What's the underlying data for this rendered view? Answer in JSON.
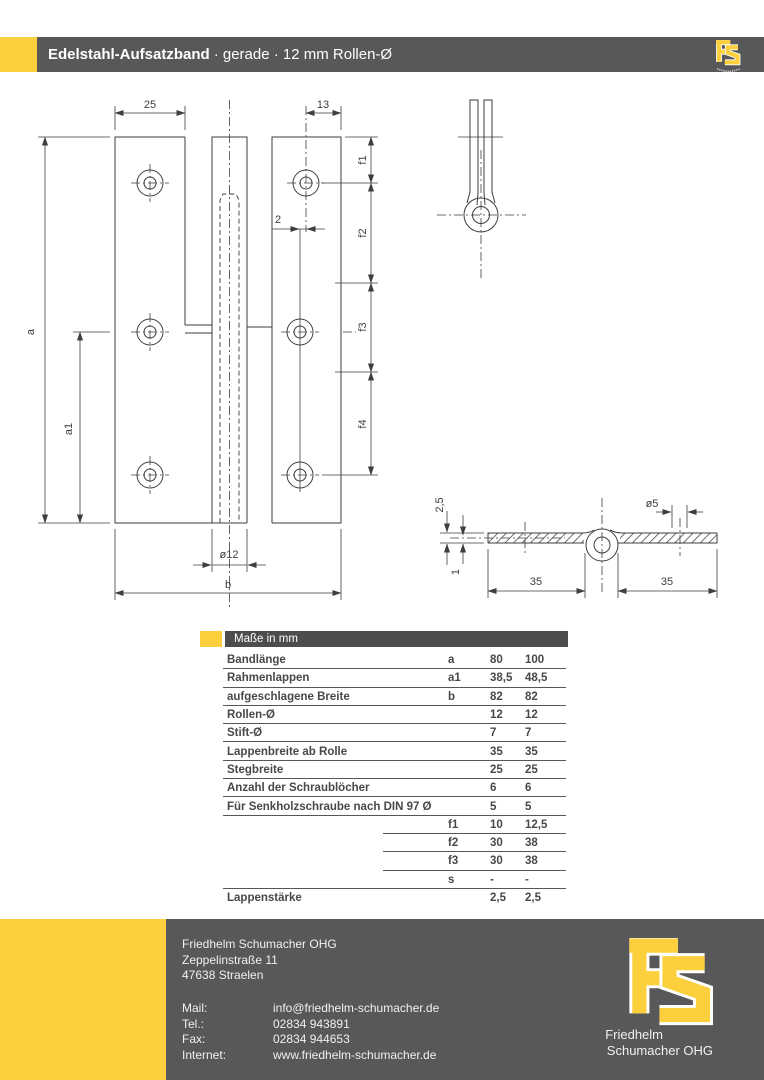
{
  "header": {
    "title": "Edelstahl-Aufsatzband",
    "subtitle": "· gerade · 12 mm Rollen-Ø",
    "logo_letters": "FS"
  },
  "drawing": {
    "front": {
      "dim_25": "25",
      "dim_13": "13",
      "dim_2": "2",
      "dim_f1": "f1",
      "dim_f2": "f2",
      "dim_f3": "f3",
      "dim_f4": "f4",
      "dim_a": "a",
      "dim_a1": "a1",
      "dim_roll": "ø12",
      "dim_b": "b"
    },
    "section": {
      "dim_thickness": "2,5",
      "dim_offset": "1",
      "dim_pin": "ø5",
      "dim_left": "35",
      "dim_right": "35"
    }
  },
  "table": {
    "header_label": "Maße in mm",
    "rows": [
      {
        "label": "Bandlänge",
        "symbol": "a",
        "v80": "80",
        "v100": "100"
      },
      {
        "label": "Rahmenlappen",
        "symbol": "a1",
        "v80": "38,5",
        "v100": "48,5"
      },
      {
        "label": "aufgeschlagene Breite",
        "symbol": "b",
        "v80": "82",
        "v100": "82"
      },
      {
        "label": "Rollen-Ø",
        "symbol": "",
        "v80": "12",
        "v100": "12"
      },
      {
        "label": "Stift-Ø",
        "symbol": "",
        "v80": "7",
        "v100": "7"
      },
      {
        "label": "Lappenbreite ab Rolle",
        "symbol": "",
        "v80": "35",
        "v100": "35"
      },
      {
        "label": "Stegbreite",
        "symbol": "",
        "v80": "25",
        "v100": "25"
      },
      {
        "label": "Anzahl der Schraublöcher",
        "symbol": "",
        "v80": "6",
        "v100": "6"
      },
      {
        "label": "Für Senkholzschraube nach DIN 97  Ø",
        "symbol": "",
        "v80": "5",
        "v100": "5"
      },
      {
        "label": "",
        "symbol": "f1",
        "v80": "10",
        "v100": "12,5"
      },
      {
        "label": "",
        "symbol": "f2",
        "v80": "30",
        "v100": "38"
      },
      {
        "label": "",
        "symbol": "f3",
        "v80": "30",
        "v100": "38"
      },
      {
        "label": "",
        "symbol": "s",
        "v80": "-",
        "v100": "-"
      },
      {
        "label": "Lappenstärke",
        "symbol": "",
        "v80": "2,5",
        "v100": "2,5"
      }
    ]
  },
  "footer": {
    "company": "Friedhelm Schumacher OHG",
    "street": "Zeppelinstraße 11",
    "city": "47638 Straelen",
    "contacts": [
      {
        "label": "Mail:",
        "value": "info@friedhelm-schumacher.de"
      },
      {
        "label": "Tel.:",
        "value": "02834 943891"
      },
      {
        "label": "Fax:",
        "value": "02834 944653"
      },
      {
        "label": "Internet:",
        "value": "www.friedhelm-schumacher.de"
      }
    ],
    "logo": {
      "letters": "FS",
      "line1": "Friedhelm",
      "line2": "Schumacher OHG"
    }
  },
  "colors": {
    "yellow": "#FBD03C",
    "gray": "#58585A",
    "table_head": "#4D4D4F",
    "line": "#3E3E40"
  }
}
